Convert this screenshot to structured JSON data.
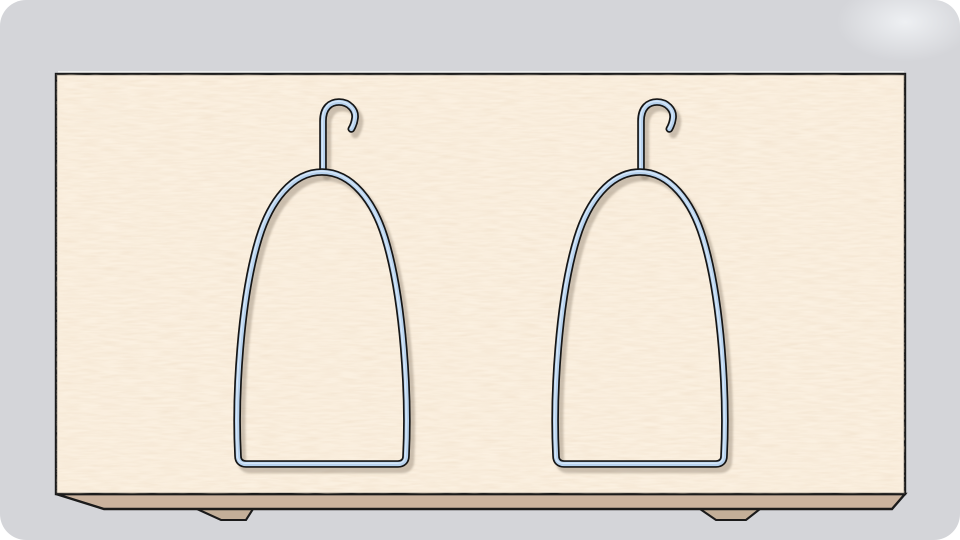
{
  "scene": {
    "hanger_count": 2,
    "objects": [
      "wooden-board",
      "board-bottom-edge",
      "board-foot-left",
      "board-foot-right",
      "wire-hanger-left",
      "wire-hanger-right"
    ]
  },
  "colors": {
    "page_bg": "#ffffff",
    "canvas_bg": "#d4d5d9",
    "sheen": "#eef0f3",
    "panel_face": "#fbf0e0",
    "panel_edge": "#cbb39e",
    "panel_foot": "#c3af99",
    "outline": "#1b1b1b",
    "top_highlight": "#f2f3f1",
    "wire_fill": "#b7d2ee",
    "wire_outline": "#161616",
    "wire_sheen": "#dcebf9",
    "wire_shadow": "#857867"
  }
}
